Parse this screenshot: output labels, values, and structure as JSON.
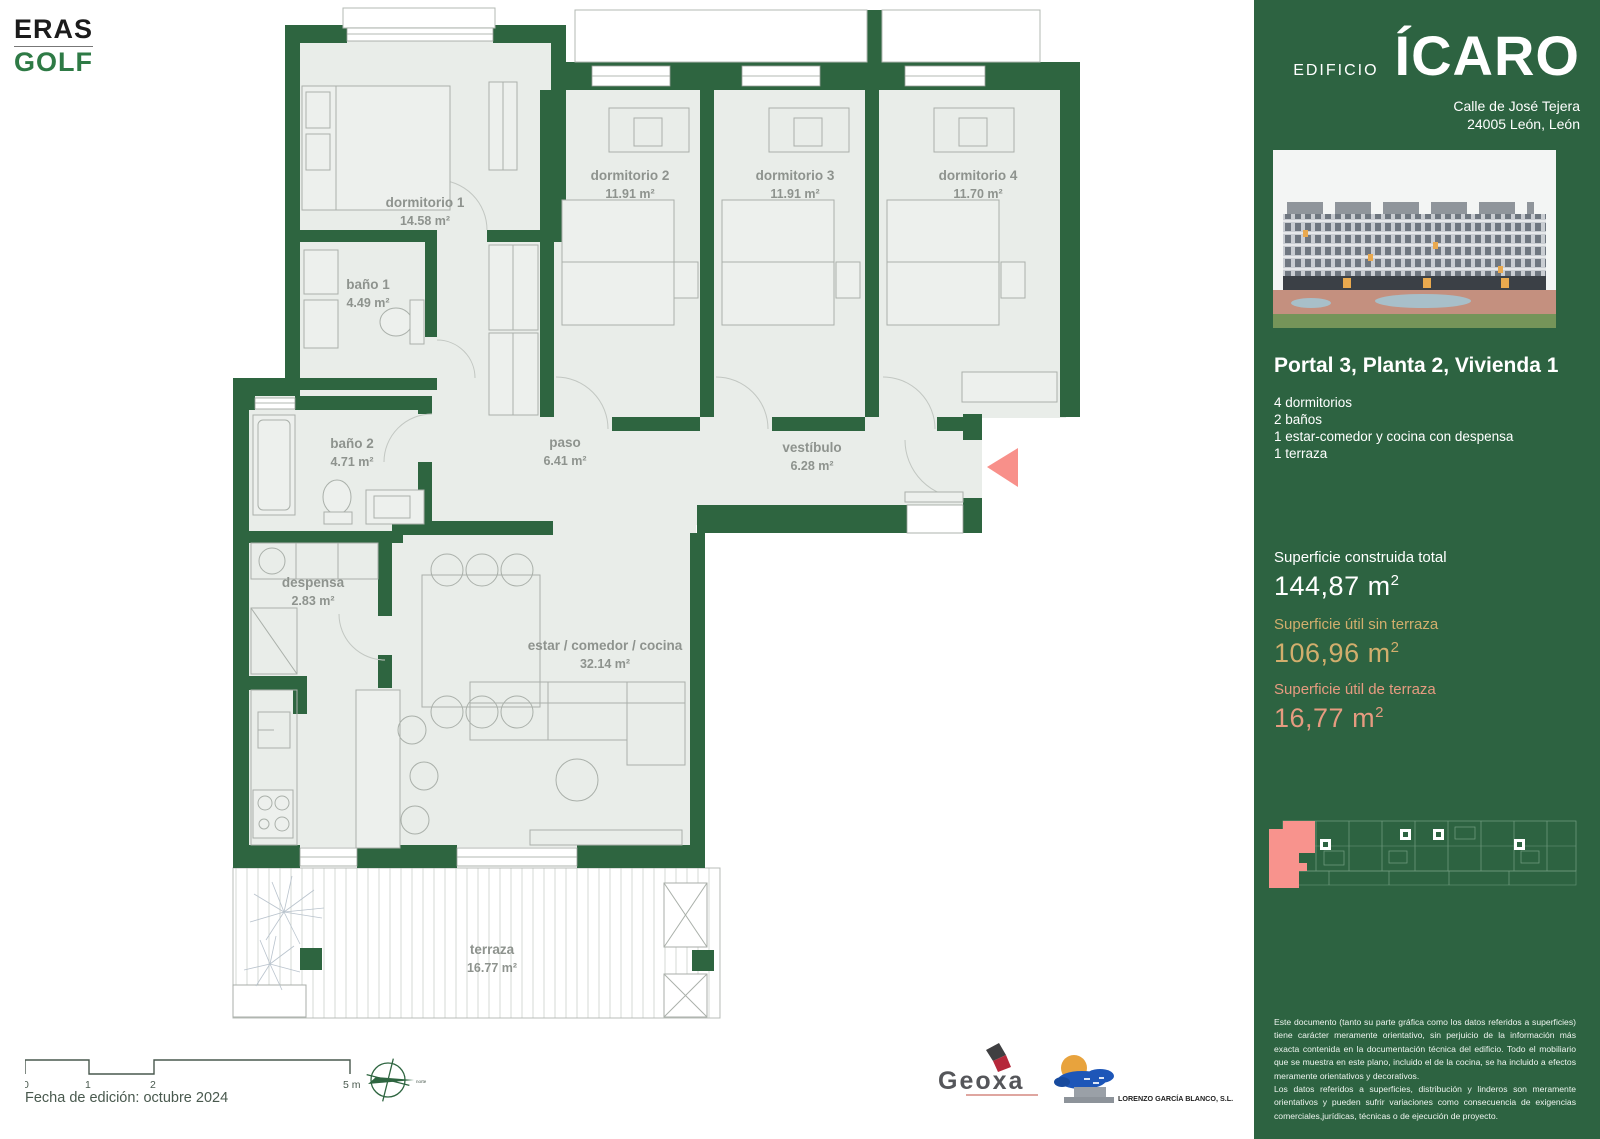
{
  "brand": {
    "line1": "ERAS",
    "line2": "GOLF",
    "accent_green": "#2e7a45"
  },
  "sidebar": {
    "building_label": "EDIFICIO",
    "building_name": "ÍCARO",
    "address_line1": "Calle de José Tejera",
    "address_line2": "24005 León, León",
    "unit_title": "Portal 3, Planta 2, Vivienda 1",
    "features": [
      "4 dormitorios",
      "2 baños",
      "1 estar-comedor y cocina con despensa",
      "1 terraza"
    ],
    "areas": [
      {
        "label": "Superficie construida total",
        "value": "144,87 m",
        "sup": "2",
        "color": "#ffffff"
      },
      {
        "label": "Superficie útil sin terraza",
        "value": "106,96 m",
        "sup": "2",
        "color": "#d2ae6d"
      },
      {
        "label": "Superficie útil de terraza",
        "value": "16,77 m",
        "sup": "2",
        "color": "#e69b80"
      }
    ],
    "disclaimer_p1": "Este documento (tanto su parte gráfica como los datos referidos a superficies) tiene carácter meramente orientativo, sin perjuicio de la información más exacta contenida en la documentación técnica del edificio. Todo el mobiliario que se muestra en este plano, incluido el de la cocina, se ha incluido a efectos meramente orientativos y decorativos.",
    "disclaimer_p2": "Los datos referidos a superficies, distribución y linderos son meramente orientativos y pueden sufrir variaciones como consecuencia de exigencias comerciales,jurídicas, técnicas o de ejecución de proyecto.",
    "colors": {
      "background": "#2d6341",
      "unit_highlight": "#f8938d"
    }
  },
  "plan": {
    "wall_color": "#2e6540",
    "entrance_arrow_color": "#f8908a",
    "rooms": [
      {
        "name": "dormitorio 1",
        "area": "14.58 m²"
      },
      {
        "name": "baño 1",
        "area": "4.49 m²"
      },
      {
        "name": "dormitorio 2",
        "area": "11.91 m²"
      },
      {
        "name": "dormitorio 3",
        "area": "11.91 m²"
      },
      {
        "name": "dormitorio 4",
        "area": "11.70 m²"
      },
      {
        "name": "baño 2",
        "area": "4.71 m²"
      },
      {
        "name": "paso",
        "area": "6.41 m²"
      },
      {
        "name": "vestíbulo",
        "area": "6.28 m²"
      },
      {
        "name": "despensa",
        "area": "2.83 m²"
      },
      {
        "name": "estar / comedor / cocina",
        "area": "32.14 m²"
      },
      {
        "name": "terraza",
        "area": "16.77 m²"
      }
    ]
  },
  "footer": {
    "scale_labels": [
      "0",
      "1",
      "2",
      "5 m"
    ],
    "edition_date": "Fecha de edición: octubre 2024",
    "compass_label": "norte",
    "partner_1": "Geoxa",
    "partner_2": "LORENZO GARCÍA BLANCO, S.L."
  }
}
